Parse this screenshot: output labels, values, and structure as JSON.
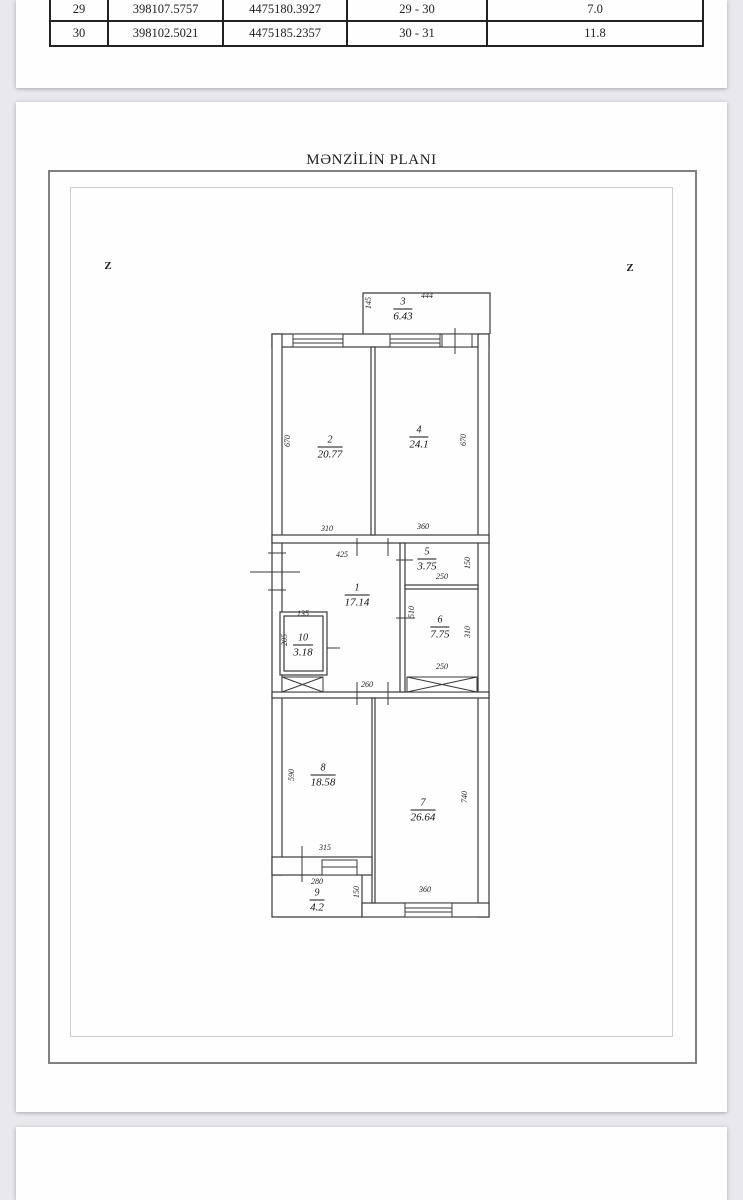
{
  "doc": {
    "title": "MƏNZİLİN PLANI",
    "compass": {
      "left": "Z",
      "right": "Z"
    }
  },
  "table": {
    "rows": [
      [
        "29",
        "398107.5757",
        "4475180.3927",
        "29 - 30",
        "7.0"
      ],
      [
        "30",
        "398102.5021",
        "4475185.2357",
        "30 - 31",
        "11.8"
      ]
    ]
  },
  "rooms": {
    "r1": {
      "num": "1",
      "area": "17.14"
    },
    "r2": {
      "num": "2",
      "area": "20.77"
    },
    "r3": {
      "num": "3",
      "area": "6.43"
    },
    "r4": {
      "num": "4",
      "area": "24.1"
    },
    "r5": {
      "num": "5",
      "area": "3.75"
    },
    "r6": {
      "num": "6",
      "area": "7.75"
    },
    "r7": {
      "num": "7",
      "area": "26.64"
    },
    "r8": {
      "num": "8",
      "area": "18.58"
    },
    "r9": {
      "num": "9",
      "area": "4.2"
    },
    "r10": {
      "num": "10",
      "area": "3.18"
    }
  },
  "dims": {
    "r3_top": "444",
    "r3_side": "145",
    "r2_side": "670",
    "r2_bottom": "310",
    "r4_side": "670",
    "r4_bottom": "360",
    "r1_top": "425",
    "r1_side": "510",
    "r1_bottom": "260",
    "r5_bottom": "250",
    "r5_side": "150",
    "r6_side": "310",
    "r6_bottom": "250",
    "r10_top": "135",
    "r10_side": "205",
    "r8_side": "590",
    "r8_bottom": "315",
    "r7_side": "740",
    "r7_bottom": "360",
    "r9_top": "280",
    "r9_side": "150"
  },
  "colors": {
    "background": "#e8e8ed",
    "paper": "#fefefe",
    "plan_line": "#3a3a3a",
    "table_border": "#222222"
  }
}
